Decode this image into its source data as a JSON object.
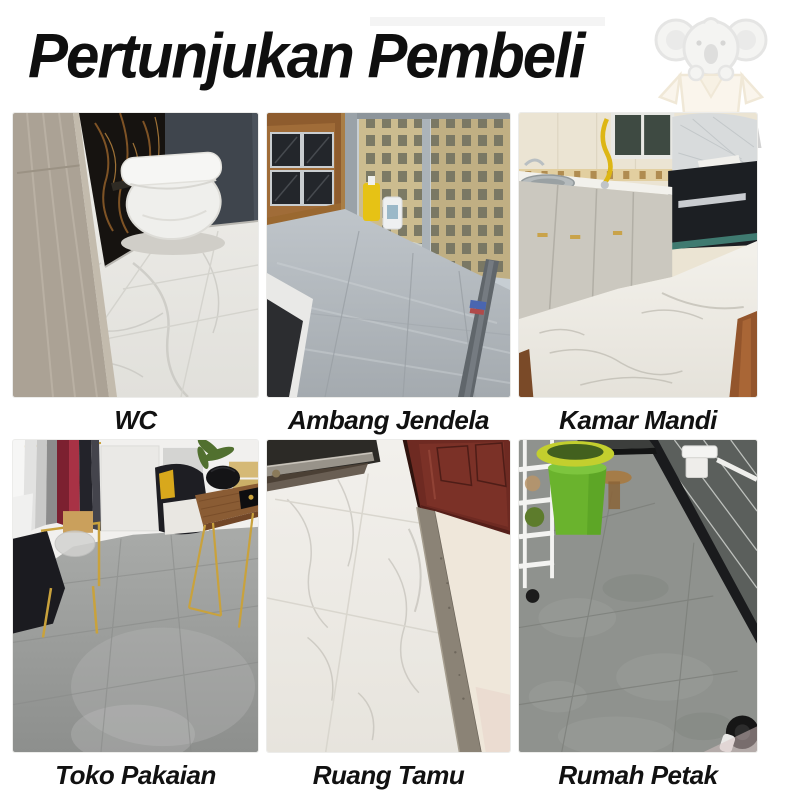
{
  "header": {
    "title": "Pertunjukan Pembeli",
    "title_color": "#0f0f0f",
    "logo_icon": "koala-in-box-watermark",
    "watermark_letter": "A",
    "watermark_color": "#d2d2d2"
  },
  "gallery": {
    "caption_color": "#111111",
    "items": [
      {
        "label": "WC",
        "scene": "toilet-room-white-marble-floor-black-gold-marble-wall"
      },
      {
        "label": "Ambang Jendela",
        "scene": "window-sill-gray-stone-tile-city-view"
      },
      {
        "label": "Kamar Mandi",
        "scene": "kitchen-white-marble-floor-gray-cabinets"
      },
      {
        "label": "Toko Pakaian",
        "scene": "clothing-store-gray-cement-floor-gold-racks"
      },
      {
        "label": "Ruang Tamu",
        "scene": "doorway-white-marble-floor-mahogany-door"
      },
      {
        "label": "Rumah Petak",
        "scene": "flat-corridor-gray-floor-dark-wall-tiles"
      }
    ]
  }
}
